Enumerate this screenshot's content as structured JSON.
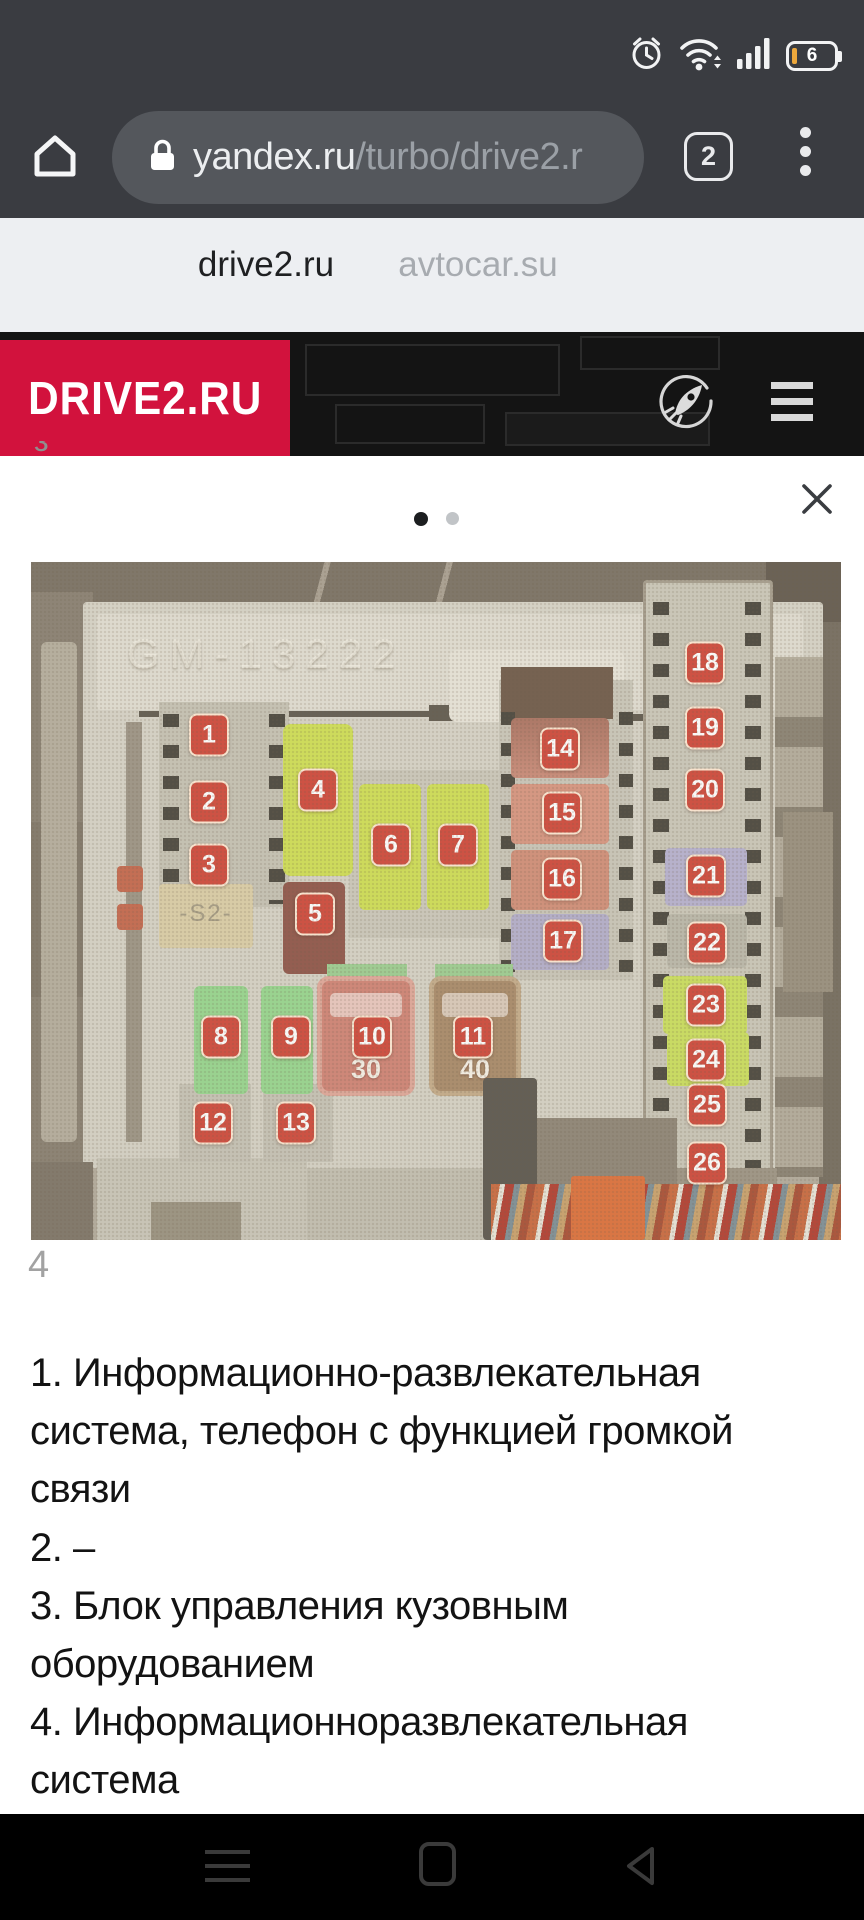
{
  "status_bar": {
    "battery_level": "6",
    "icons": [
      "alarm-clock",
      "wifi",
      "signal-strength",
      "battery"
    ]
  },
  "url_bar": {
    "domain": "yandex.ru",
    "path": "/turbo/drive2.r",
    "tab_count": "2"
  },
  "tab_switcher": {
    "tabs": [
      {
        "label": "drive2.ru",
        "active": true
      },
      {
        "label": "avtocar.su",
        "active": false
      }
    ]
  },
  "site_header": {
    "brand": "DRIVE2.RU",
    "brand_color": "#d2123d",
    "partial_glyph": "з"
  },
  "photo": {
    "embossed_text": "GM-13222",
    "caption": "4",
    "s2_marking": "-S2-",
    "label_color": "#ce4537",
    "big_fuses": {
      "fuse10_rating": "30",
      "fuse11_rating": "40"
    },
    "fuse_labels": [
      {
        "n": "1",
        "x": 178,
        "y": 173
      },
      {
        "n": "2",
        "x": 178,
        "y": 240
      },
      {
        "n": "3",
        "x": 178,
        "y": 303
      },
      {
        "n": "4",
        "x": 287,
        "y": 228
      },
      {
        "n": "5",
        "x": 284,
        "y": 352
      },
      {
        "n": "6",
        "x": 360,
        "y": 283
      },
      {
        "n": "7",
        "x": 427,
        "y": 283
      },
      {
        "n": "8",
        "x": 190,
        "y": 475
      },
      {
        "n": "9",
        "x": 260,
        "y": 475
      },
      {
        "n": "10",
        "x": 341,
        "y": 475
      },
      {
        "n": "11",
        "x": 442,
        "y": 475
      },
      {
        "n": "12",
        "x": 182,
        "y": 561
      },
      {
        "n": "13",
        "x": 265,
        "y": 561
      },
      {
        "n": "14",
        "x": 529,
        "y": 187
      },
      {
        "n": "15",
        "x": 531,
        "y": 251
      },
      {
        "n": "16",
        "x": 531,
        "y": 317
      },
      {
        "n": "17",
        "x": 532,
        "y": 379
      },
      {
        "n": "18",
        "x": 674,
        "y": 101
      },
      {
        "n": "19",
        "x": 674,
        "y": 166
      },
      {
        "n": "20",
        "x": 674,
        "y": 228
      },
      {
        "n": "21",
        "x": 675,
        "y": 314
      },
      {
        "n": "22",
        "x": 676,
        "y": 381
      },
      {
        "n": "23",
        "x": 675,
        "y": 443
      },
      {
        "n": "24",
        "x": 675,
        "y": 498
      },
      {
        "n": "25",
        "x": 676,
        "y": 543
      },
      {
        "n": "26",
        "x": 676,
        "y": 601
      }
    ]
  },
  "description": {
    "lines": [
      "1. Информационно-развлекательная",
      "система, телефон с функцией громкой",
      "связи",
      "2. –",
      "3. Блок управления кузовным",
      "оборудованием",
      "4. Информационноразвлекательная",
      "система"
    ]
  },
  "nav_bar": {
    "icons": [
      "recent-menu",
      "home",
      "back"
    ]
  }
}
